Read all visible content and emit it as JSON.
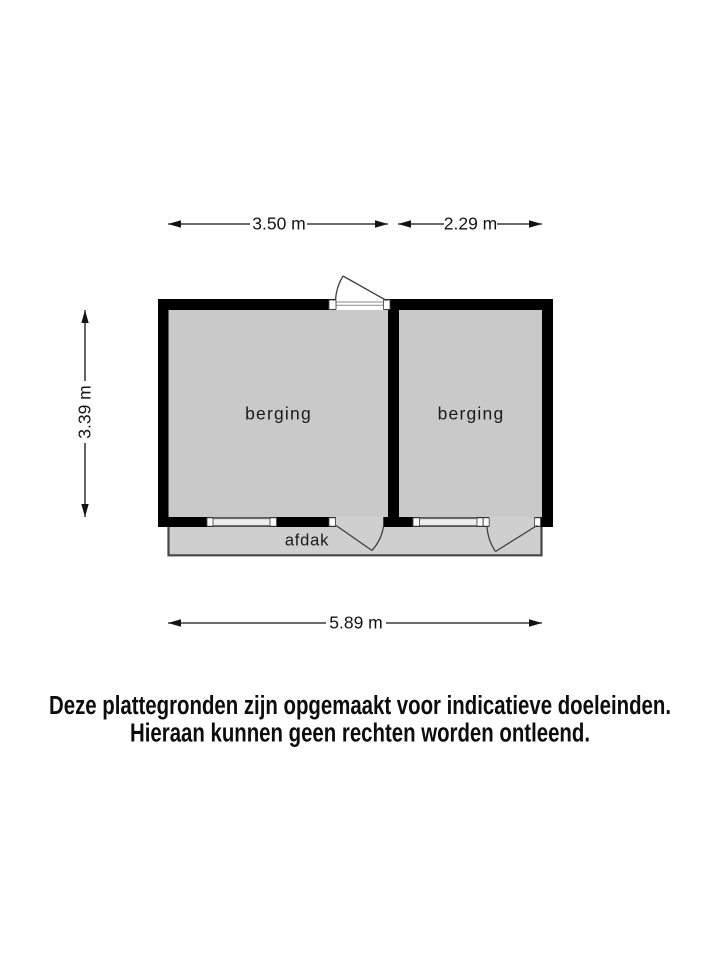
{
  "plan": {
    "rooms": [
      {
        "label": "berging"
      },
      {
        "label": "berging"
      }
    ],
    "canopy": {
      "label": "afdak"
    },
    "dimensions": {
      "top_left": "3.50 m",
      "top_right": "2.29 m",
      "left": "3.39 m",
      "bottom": "5.89 m"
    },
    "colors": {
      "wall": "#000000",
      "room_fill": "#c9c9c9",
      "canopy_fill": "#cfcfcf",
      "window_fill": "#ededed",
      "opening_fill": "#ffffff"
    }
  },
  "disclaimer": {
    "line1": "Deze plattegronden zijn opgemaakt voor indicatieve doeleinden.",
    "line2": "Hieraan kunnen geen rechten worden ontleend."
  }
}
